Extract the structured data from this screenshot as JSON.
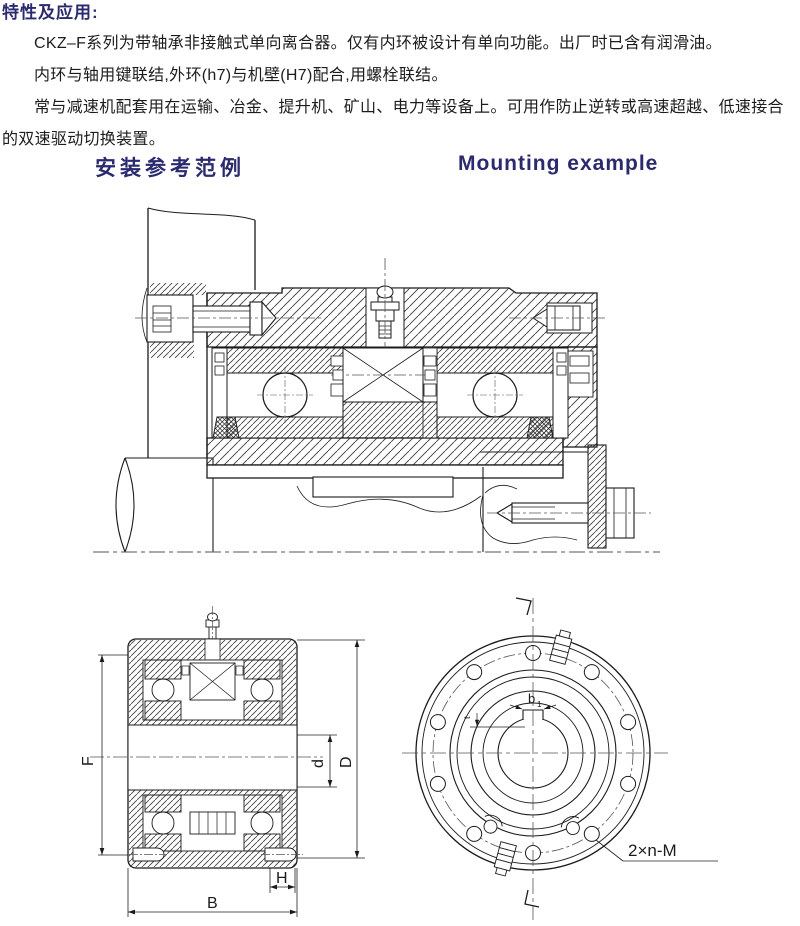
{
  "page": {
    "background": "#ffffff",
    "accent_color": "#2b2a6e",
    "text_color": "#1c1c1c"
  },
  "intro": {
    "heading": "特性及应用:",
    "paragraphs": [
      "CKZ–F系列为带轴承非接触式单向离合器。仅有内环被设计有单向功能。出厂时已含有润滑油。",
      "内环与轴用键联结,外环(h7)与机壁(H7)配合,用螺栓联结。",
      "常与减速机配套用在运输、冶金、提升机、矿山、电力等设备上。可用作防止逆转或高速超越、低速接合的双速驱动切换装置。"
    ]
  },
  "section_titles": {
    "zh": "安装参考范例",
    "en": "Mounting example"
  },
  "drawings": {
    "section_view": {
      "dims": {
        "F": "F",
        "d": "d",
        "D": "D",
        "H": "H",
        "B": "B"
      }
    },
    "front_view": {
      "keyway_width_label": "b",
      "keyway_width_sub": "1",
      "keyway_depth_label": "t",
      "bolt_holes_note": "2×n-M"
    }
  }
}
